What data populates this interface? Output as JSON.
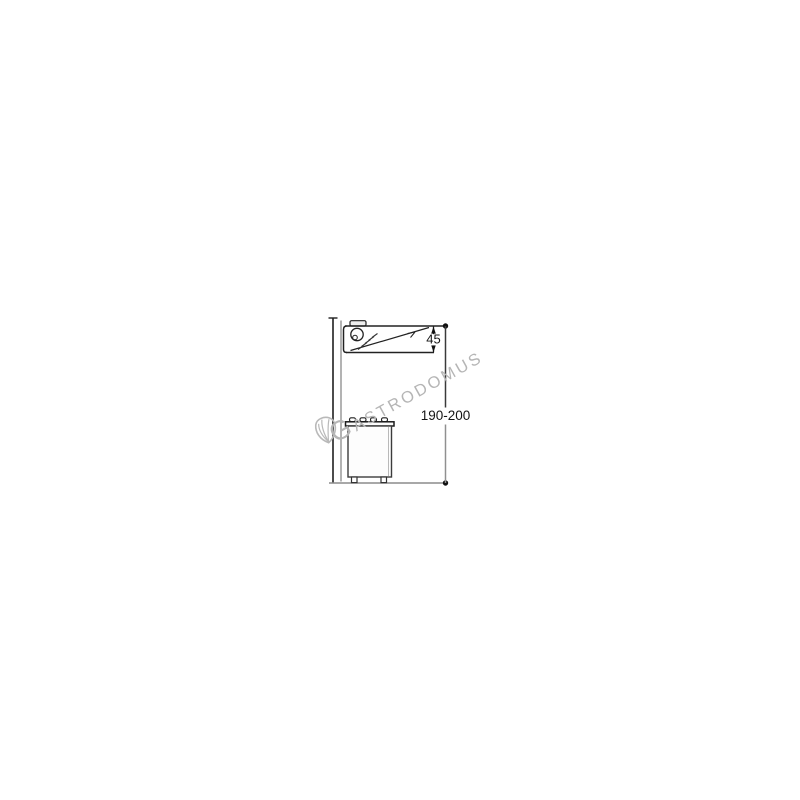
{
  "page": {
    "background_color": "#ffffff",
    "content": "technical installation side-view drawing of a wall-mounted extractor hood above a cooker"
  },
  "watermark": {
    "initial": "G",
    "rest": "ASTRODOMUS",
    "full_text": "GASTRODOMUS",
    "logo_icon": "shell-icon",
    "color": "#b5b5b5"
  },
  "drawing": {
    "dimensions": {
      "hood_height": "45",
      "installation_height": "190-200"
    },
    "colors": {
      "line_dark": "#222222",
      "wall_gray": "#a0a0a0",
      "dim_lower_gray": "#8c8c8c",
      "floor_gray": "#8c8c8c"
    }
  }
}
